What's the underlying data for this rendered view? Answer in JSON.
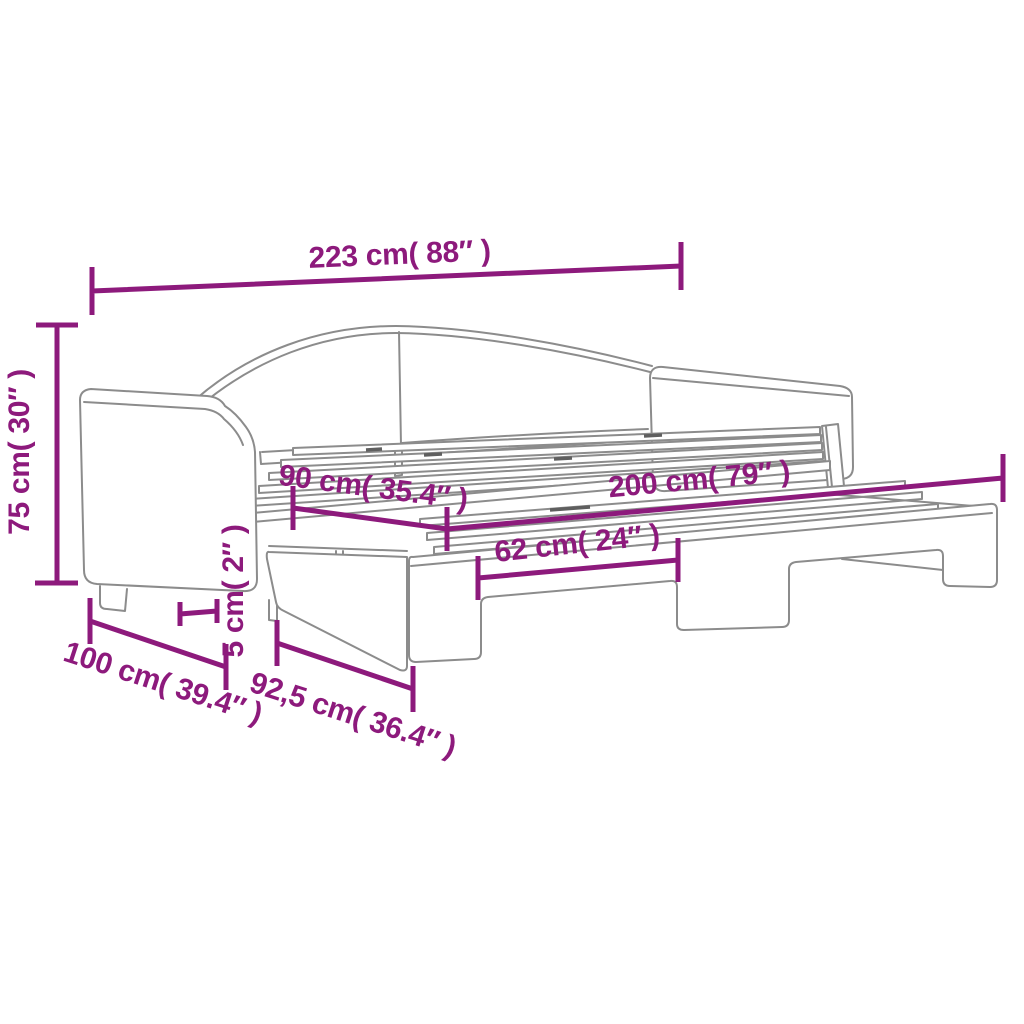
{
  "page": {
    "title": "Daybed with pull-out trundle bed — dimension diagram"
  },
  "diagram": {
    "type": "product-dimension-line-drawing",
    "colors": {
      "accent": "#8D1A7C",
      "line_art": "#8C8C8C",
      "background": "#FFFFFF"
    },
    "dimensions": [
      {
        "id": "total-length",
        "label": "223 cm( 88″  )"
      },
      {
        "id": "total-height",
        "label": "75 cm( 30″  )"
      },
      {
        "id": "sleeping-width",
        "label": "90 cm( 35.4″  )"
      },
      {
        "id": "sleeping-length",
        "label": "200 cm( 79″  )"
      },
      {
        "id": "leg-spacing",
        "label": "62 cm( 24″  )"
      },
      {
        "id": "clearance",
        "label": "5 cm( 2″  )"
      },
      {
        "id": "total-depth",
        "label": "100 cm( 39.4″  )"
      },
      {
        "id": "trundle-depth",
        "label": "92,5 cm( 36.4″  )"
      }
    ]
  }
}
